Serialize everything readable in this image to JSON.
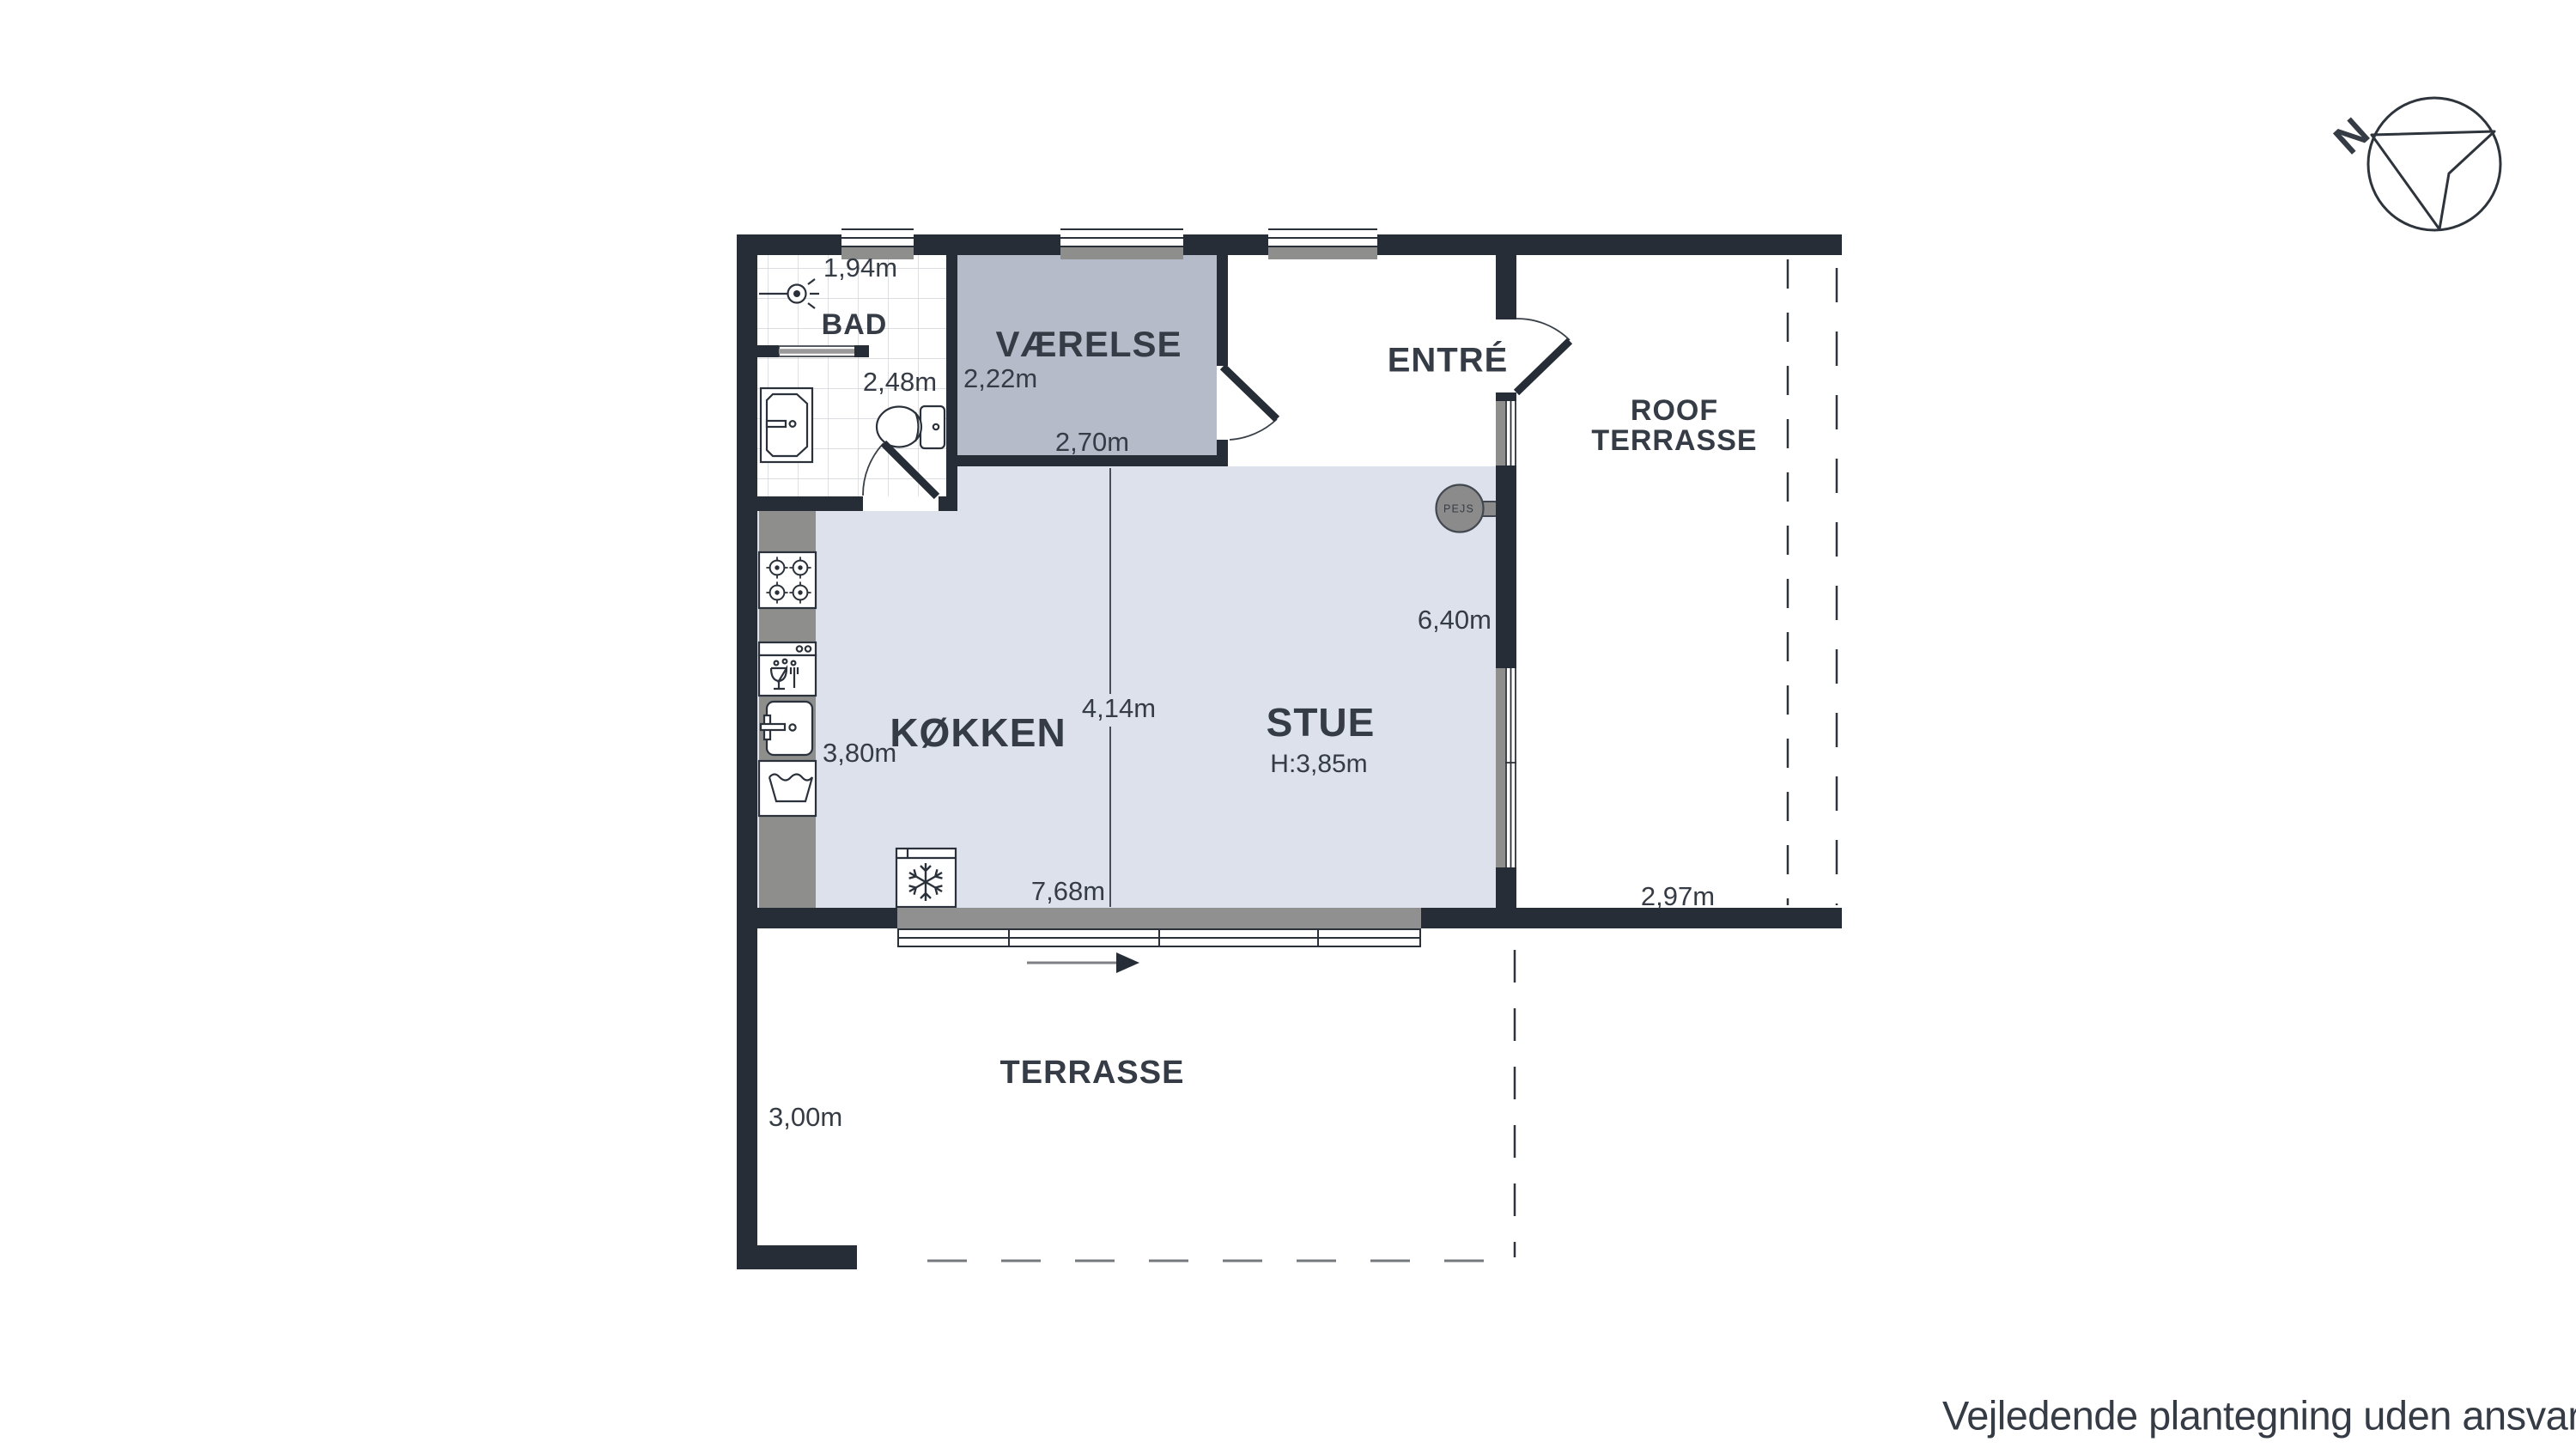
{
  "rooms": {
    "bad": {
      "label": "BAD",
      "width": "1,94m",
      "depth": "2,48m"
    },
    "vaerelse": {
      "label": "VÆRELSE",
      "width_left": "2,22m",
      "width_bottom": "2,70m"
    },
    "entre": {
      "label": "ENTRÉ"
    },
    "koekken": {
      "label": "KØKKEN",
      "depth": "3,80m",
      "split_width": "4,14m"
    },
    "stue": {
      "label": "STUE",
      "ceiling_height": "H:3,85m",
      "width": "7,68m",
      "depth": "6,40m"
    },
    "roof_terrasse": {
      "label_line1": "ROOF",
      "label_line2": "TERRASSE",
      "width": "2,97m"
    },
    "terrasse": {
      "label": "TERRASSE",
      "depth": "3,00m"
    }
  },
  "fireplace": {
    "label": "PEJS"
  },
  "compass": {
    "north_letter": "N"
  },
  "footer": {
    "disclaimer": "Vejledende plantegning uden ansvar"
  },
  "colors": {
    "wall": "#272d36",
    "open_floor": "#dce1ec",
    "bedroom_floor": "#b5bbc8",
    "counter_gray": "#8e8e8d",
    "text": "#363c45",
    "tile_line": "#cfd2d6",
    "dash_dark": "#2e343c",
    "dash_light": "#75797e"
  }
}
